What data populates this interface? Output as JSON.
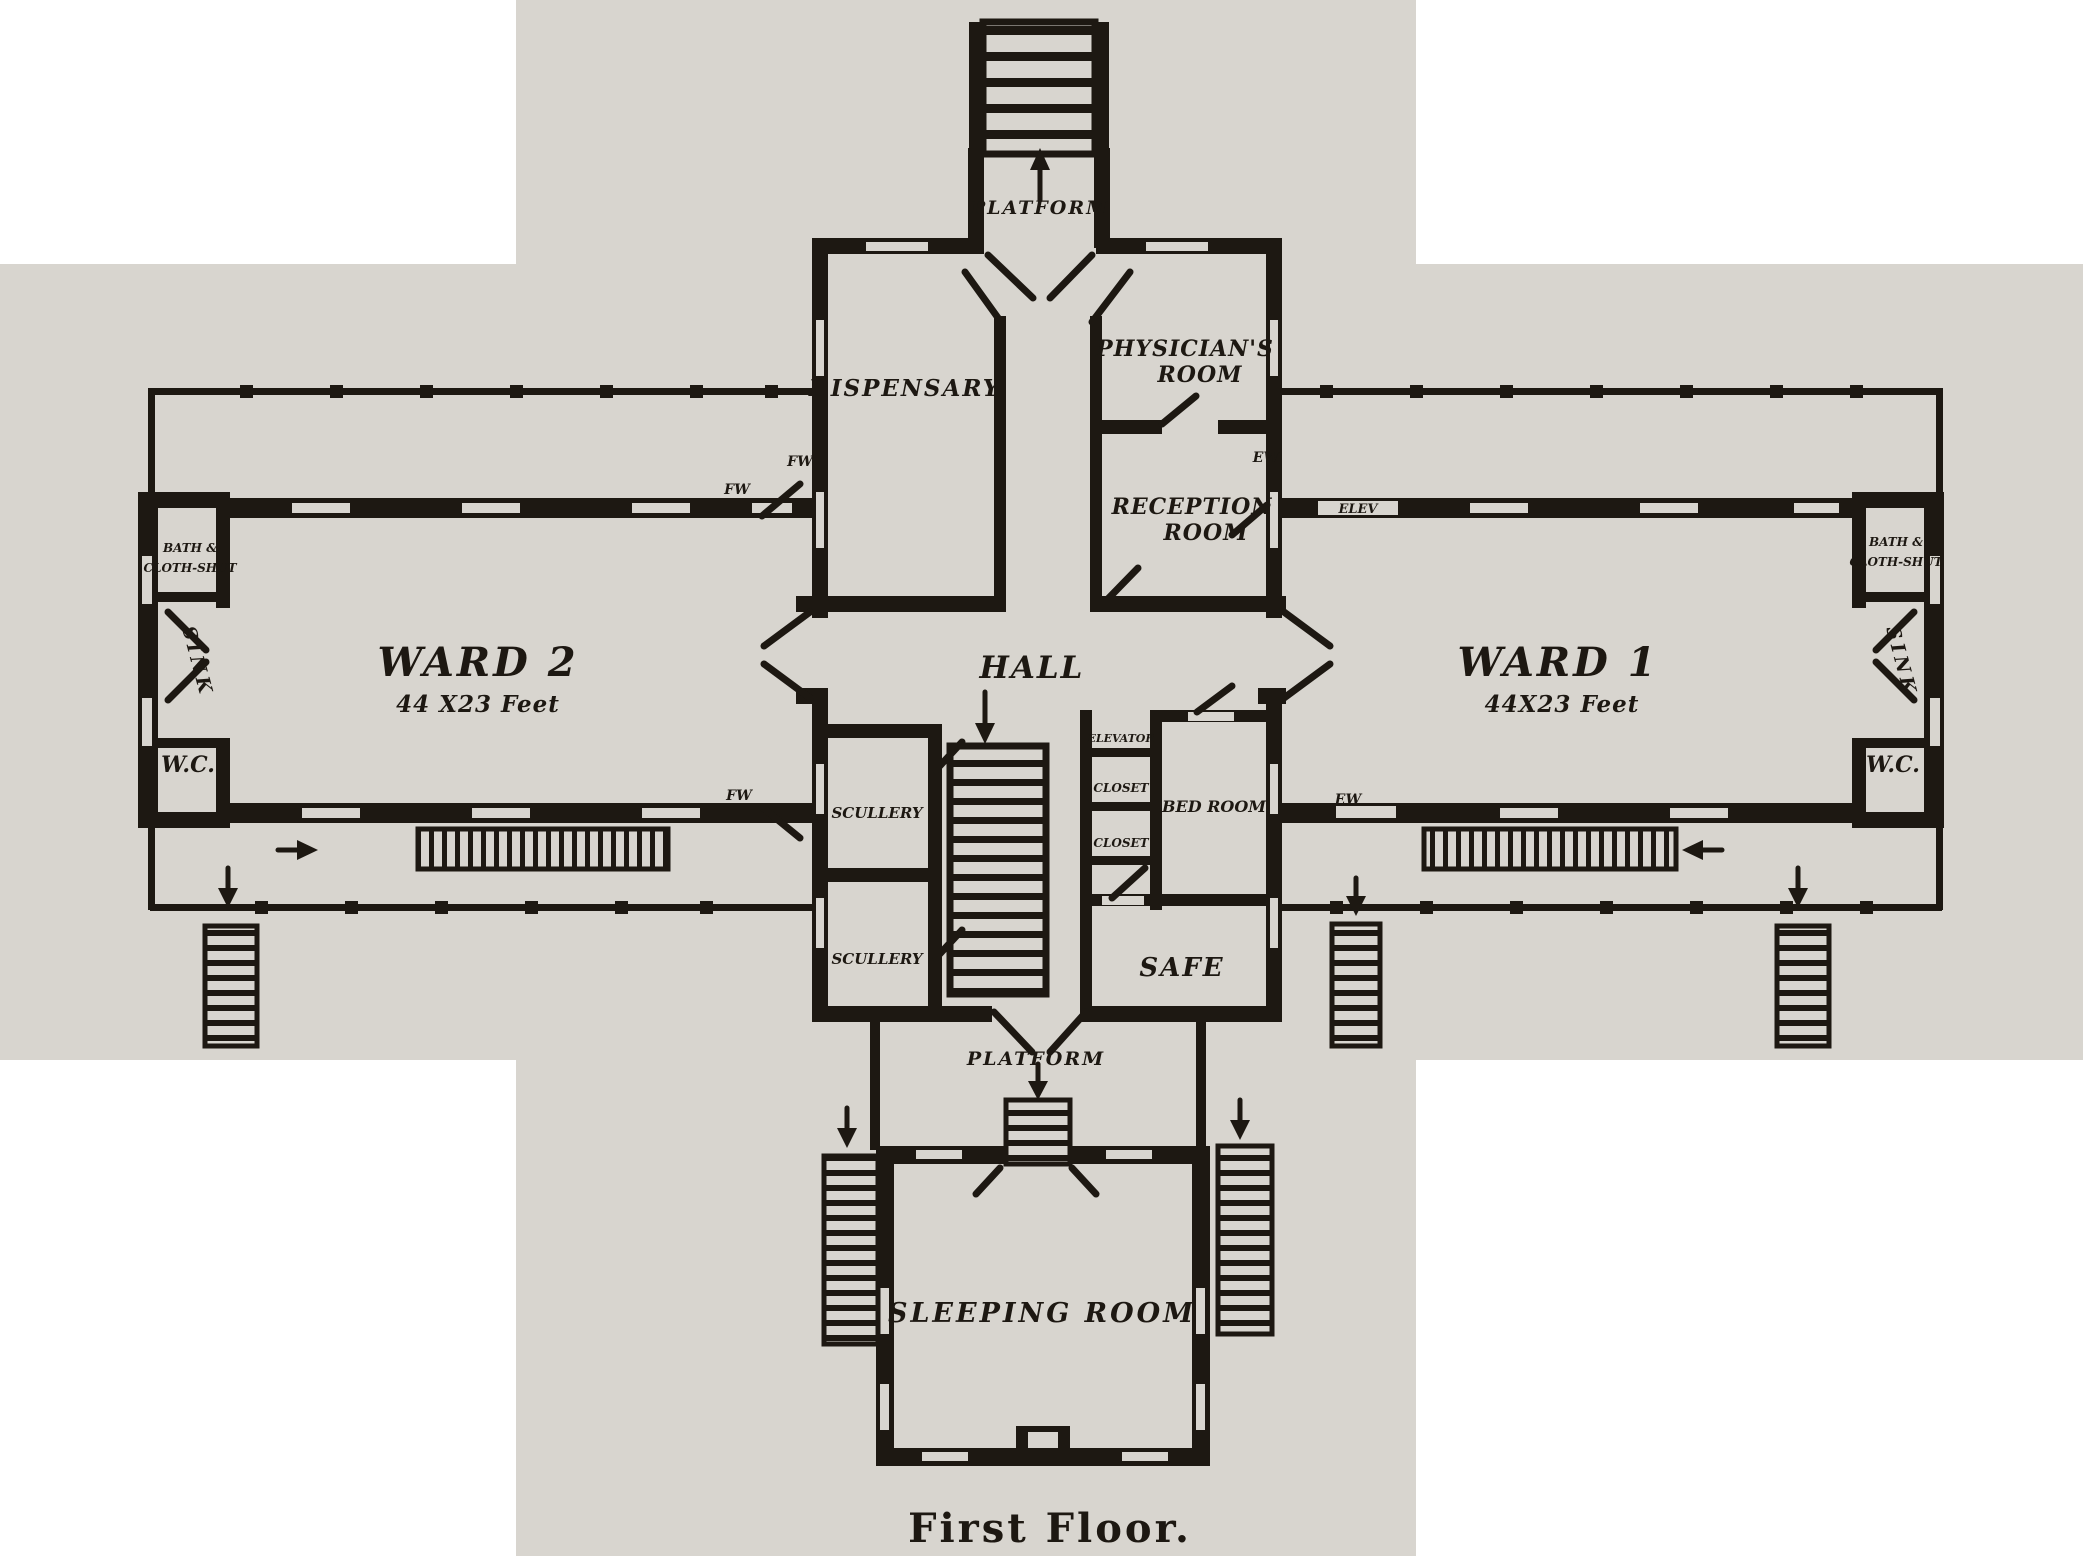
{
  "document": {
    "caption": "First Floor."
  },
  "palette": {
    "paper": "#d8d5cf",
    "ink": "#1d1812",
    "background": "#ffffff"
  },
  "rooms": {
    "platform_top": "PLATFORM",
    "dispensary": "DISPENSARY",
    "physicians": {
      "line1": "PHYSICIAN'S",
      "line2": "ROOM"
    },
    "reception": {
      "line1": "RECEPTION",
      "line2": "ROOM"
    },
    "hall": "HALL",
    "ward2": {
      "name": "WARD 2",
      "dims": "44 X23 Feet"
    },
    "ward1": {
      "name": "WARD 1",
      "dims": "44X23 Feet"
    },
    "bath_left": {
      "line1": "BATH &",
      "line2": "CLOTH-SHUT"
    },
    "sink_left": "SINK",
    "wc_left": "W.C.",
    "bath_right": {
      "line1": "BATH &",
      "line2": "CLOTH-SHUT"
    },
    "sink_right": "SINK",
    "wc_right": "W.C.",
    "scullery_upper": "SCULLERY",
    "scullery_lower": "SCULLERY",
    "elevator": "ELEVATOR",
    "closet_a": "CLOSET",
    "closet_b": "CLOSET",
    "bed_room": "BED ROOM",
    "safe": "SAFE",
    "platform_bottom": "PLATFORM",
    "sleeping_room": "SLEEPING ROOM"
  },
  "annotations": {
    "fw_a": "FW",
    "fw_b": "FW",
    "fw_c": "FW",
    "ew_a": "EW",
    "ew_b": "EW",
    "elev": "ELEV"
  }
}
